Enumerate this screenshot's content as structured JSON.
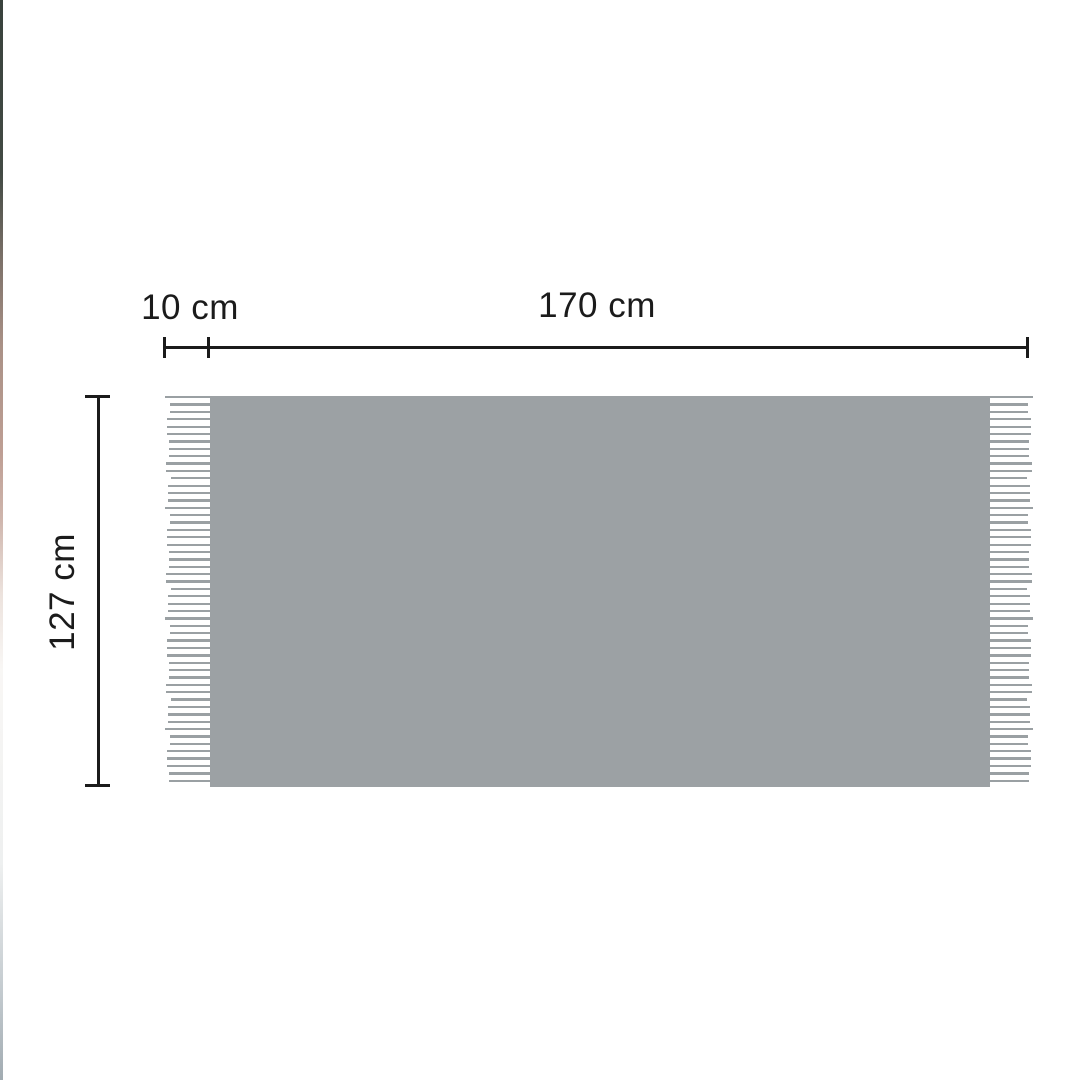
{
  "page": {
    "background": "#ffffff"
  },
  "diagram": {
    "type": "product-dimension-diagram",
    "subject": "blanket-with-fringe-tassels",
    "labels": {
      "fringe_width": "10 cm",
      "width": "170 cm",
      "height": "127 cm"
    },
    "colors": {
      "blanket": "#9ca1a4",
      "fringe": "#9aa0a3",
      "dimension": "#1b1b1b",
      "background": "#ffffff"
    },
    "fringe": {
      "line_count": 53
    }
  }
}
